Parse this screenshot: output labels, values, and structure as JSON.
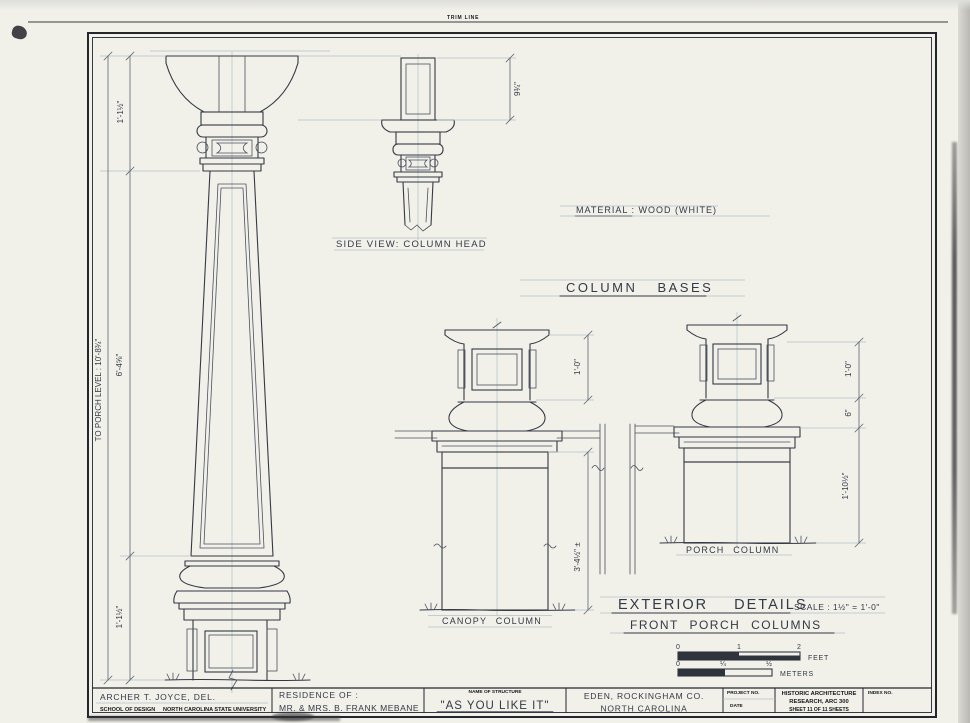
{
  "sheet": {
    "trim_line_label": "TRIM LINE"
  },
  "drawing": {
    "side_view_label": "SIDE VIEW: COLUMN HEAD",
    "material_note": "MATERIAL : WOOD (WHITE)",
    "column_bases_heading": "COLUMN BASES",
    "canopy_column_label": "CANOPY COLUMN",
    "porch_column_label": "PORCH COLUMN",
    "exterior_details_heading": "EXTERIOR DETAILS",
    "scale_note": "SCALE : 1½\" = 1'-0\"",
    "front_porch_columns_heading": "FRONT PORCH COLUMNS"
  },
  "dimensions": {
    "capital_height": "1'-1½\"",
    "to_porch_level": "TO PORCH LEVEL : 10'-8¾\"",
    "shaft_height": "6'-4⅝\"",
    "base_height": "1'-1½\"",
    "head_side_depth": "9¾\"",
    "canopy_base_height": "1'-0\"",
    "canopy_pier_height": "3'-4½\" ±",
    "porch_base_height": "1'-0\"",
    "porch_base_lower": "6\"",
    "porch_pier_height": "1'-10½\""
  },
  "scale_bars": {
    "feet": {
      "ticks": [
        "0",
        "1",
        "2"
      ],
      "unit": "FEET"
    },
    "meters": {
      "ticks": [
        "0",
        "¼",
        "½"
      ],
      "unit": "METERS"
    }
  },
  "title_block": {
    "delineator": "ARCHER T. JOYCE, DEL.",
    "school": "SCHOOL OF DESIGN",
    "university": "NORTH CAROLINA STATE UNIVERSITY",
    "residence_label": "RESIDENCE OF :",
    "residents": "MR. & MRS. B. FRANK MEBANE",
    "structure_label": "NAME OF STRUCTURE",
    "structure_name": "\"AS YOU LIKE IT\"",
    "city_county": "EDEN, ROCKINGHAM CO.",
    "state": "NORTH CAROLINA",
    "project_no_label": "PROJECT NO.",
    "date_label": "DATE",
    "org_line1": "HISTORIC ARCHITECTURE",
    "org_line2": "RESEARCH, ARC 300",
    "sheet_text": "SHEET 11 OF 11 SHEETS",
    "index_no_label": "INDEX NO."
  }
}
